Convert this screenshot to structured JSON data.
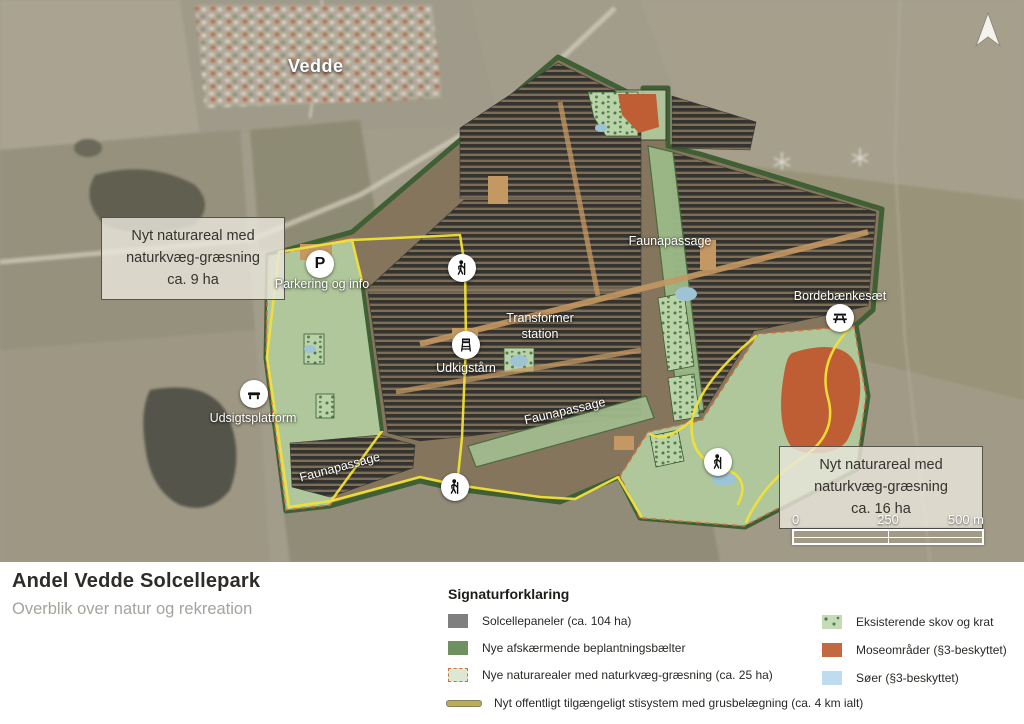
{
  "map": {
    "town_label": "Vedde",
    "callout_9ha": {
      "line1": "Nyt naturareal med",
      "line2": "naturkvæg-græsning",
      "line3": "ca. 9 ha"
    },
    "callout_16ha": {
      "line1": "Nyt naturareal med",
      "line2": "naturkvæg-græsning",
      "line3": "ca. 16 ha"
    },
    "labels": {
      "parkering": "Parkering og info",
      "faunapassage_top": "Faunapassage",
      "faunapassage_mid": "Faunapassage",
      "faunapassage_bottom": "Faunapassage",
      "transformer_line1": "Transformer",
      "transformer_line2": "station",
      "udkigstaarn": "Udkigstårn",
      "udsigtsplatform": "Udsigtsplatform",
      "bordebaenkesaet": "Bordebænkesæt"
    },
    "icons": {
      "parking_letter": "P"
    },
    "scale_bar": {
      "tick0": "0",
      "tick250": "250",
      "tick500": "500 m"
    }
  },
  "footer": {
    "title": "Andel Vedde Solcellepark",
    "subtitle": "Overblik over natur og rekreation"
  },
  "legend": {
    "title": "Signaturforklaring",
    "left": [
      {
        "label": "Solcellepaneler (ca. 104 ha)",
        "color": "#7f7f7f"
      },
      {
        "label": "Nye afskærmende beplantningsbælter",
        "color": "#6f9061"
      },
      {
        "label": "Nye naturarealer med naturkvæg-græsning (ca. 25 ha)",
        "color": "#dce8d2",
        "border": "#cf7040"
      },
      {
        "label": "Nyt offentligt tilgængeligt stisystem med grusbelægning (ca. 4 km ialt)",
        "color": "#b9ae55"
      }
    ],
    "right": [
      {
        "label": "Eksisterende skov og krat",
        "color": "#c5dbb7"
      },
      {
        "label": "Moseområder (§3-beskyttet)",
        "color": "#c2693f"
      },
      {
        "label": "Søer (§3-beskyttet)",
        "color": "#bedced"
      }
    ]
  }
}
